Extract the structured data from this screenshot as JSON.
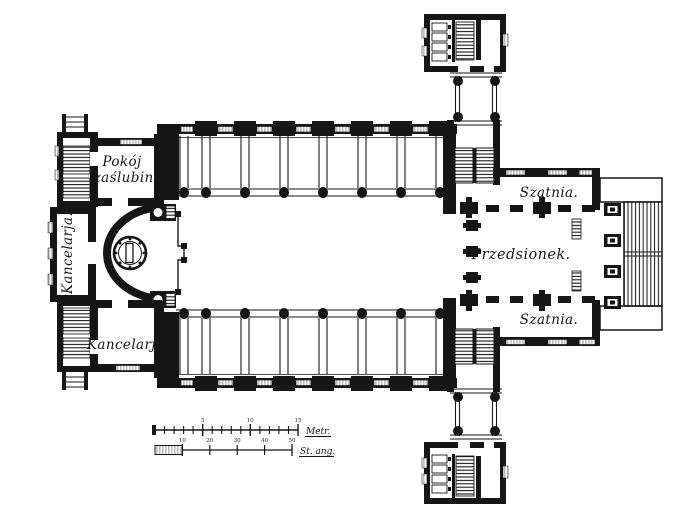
{
  "palette": {
    "ink": "#161616",
    "paper": "#ffffff"
  },
  "rooms": {
    "wedding_room": {
      "line1": "Pokój",
      "line2": "zaślubin."
    },
    "office_left": {
      "label": "Kancelarja."
    },
    "office_bottom": {
      "label": "Kancelarja."
    },
    "cloakroom_top": {
      "label": "Szatnia."
    },
    "vestibule": {
      "label": "Przedsionek."
    },
    "cloakroom_bottom": {
      "label": "Szatnia."
    }
  },
  "scale_bars": {
    "metric": {
      "label": "Metr.",
      "tick_labels": [
        "5",
        "10",
        "15"
      ]
    },
    "english": {
      "label": "St. ang.",
      "tick_labels": [
        "10",
        "20",
        "30",
        "40",
        "50"
      ]
    }
  }
}
